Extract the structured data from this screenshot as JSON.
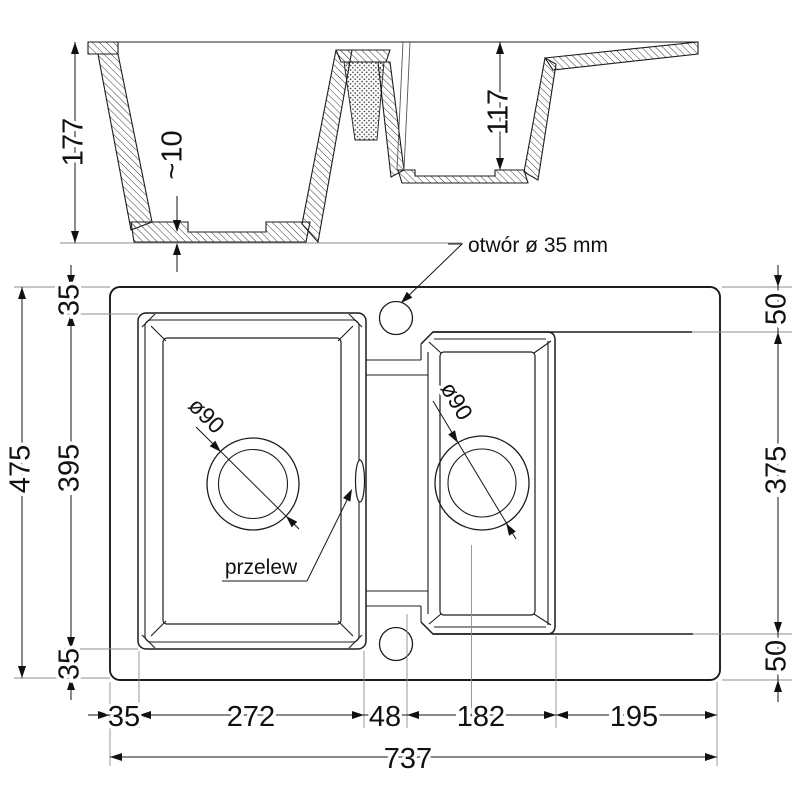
{
  "section_view": {
    "depth_main": "177",
    "bottom_thickness": "~10",
    "depth_small": "117"
  },
  "plan_view": {
    "hole_label": "otwór ø 35 mm",
    "overflow_label": "przelew",
    "main_drain": "ø90",
    "small_drain": "ø90",
    "total_height": "475",
    "total_width": "737",
    "left_chain": [
      "35",
      "395",
      "35"
    ],
    "right_chain": [
      "50",
      "375",
      "50"
    ],
    "bottom_chain": [
      "35",
      "272",
      "48",
      "182",
      "195"
    ]
  },
  "colors": {
    "line": "#1c1c1c",
    "extension": "#8e8e8e",
    "background": "#ffffff"
  }
}
